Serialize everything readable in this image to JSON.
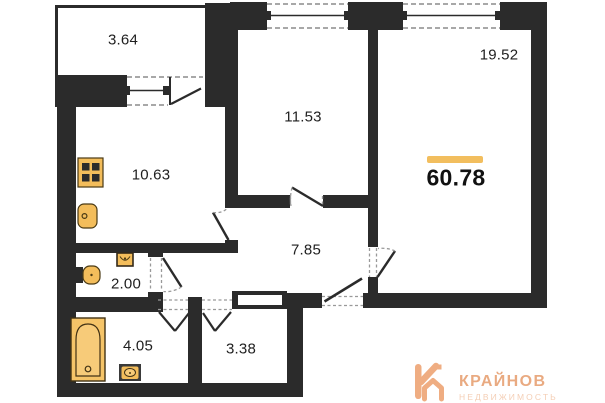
{
  "floorplan": {
    "total_area": "60.78",
    "rooms": [
      {
        "name": "balcony",
        "area": "3.64"
      },
      {
        "name": "bedroom",
        "area": "11.53"
      },
      {
        "name": "living-room",
        "area": "19.52"
      },
      {
        "name": "kitchen",
        "area": "10.63"
      },
      {
        "name": "hallway",
        "area": "7.85"
      },
      {
        "name": "wc",
        "area": "2.00"
      },
      {
        "name": "bathroom",
        "area": "4.05"
      },
      {
        "name": "storage",
        "area": "3.38"
      }
    ],
    "fixtures": [
      "stove",
      "kitchen-sink",
      "toilet",
      "wc-sink",
      "bathtub",
      "bath-sink"
    ],
    "colors": {
      "wall": "#2b2b2b",
      "fixture_fill": "#F3BD5B",
      "fixture_stroke": "#4a3a14",
      "accent_bar": "#F2BE5E"
    }
  },
  "logo": {
    "title": "КРАЙНОВ",
    "subtitle": "НЕДВИЖИМОСТЬ",
    "color": "#E79F70",
    "subtitle_color": "#F3C8AB"
  }
}
